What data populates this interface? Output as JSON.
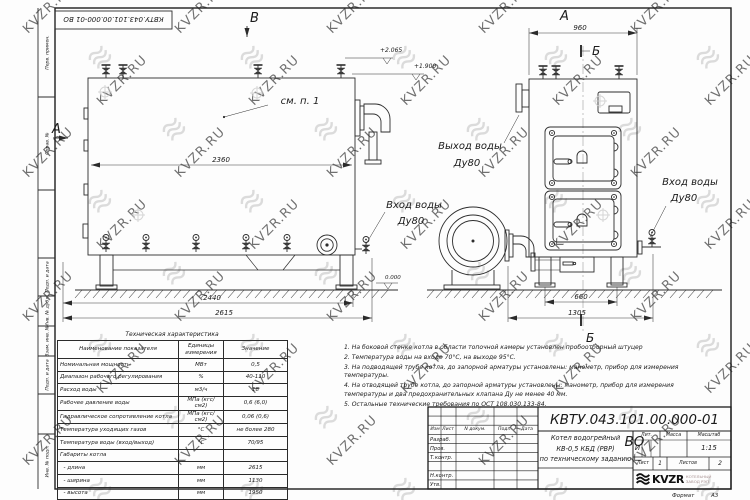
{
  "stamp": {
    "doc_number": "КВТУ.043.101.00.000-01 ВО"
  },
  "frame": {
    "margin_labels": [
      "Перв. примен.",
      "Справ. №",
      "Подп. и дата",
      "Инв. № дубл.",
      "Взам. инв. №",
      "Подп. и дата",
      "Инв. № подл."
    ],
    "format_label": "Формат",
    "format_value": "А3"
  },
  "watermark": {
    "text": "KVZR.RU"
  },
  "left_view": {
    "view_letter_b": "В",
    "section_letter_a": "А",
    "see_note": "см. п. 1",
    "dim_inner": "2360",
    "dim_base": "2440",
    "dim_overall": "2615",
    "elev_top": "+2.065",
    "elev_mid": "+1.900",
    "elev_zero": "0.000",
    "inlet_line1": "Вход воды",
    "inlet_line2": "Ду80"
  },
  "right_view": {
    "view_letter_a": "А",
    "dim_top": "960",
    "section_letter_top": "Б",
    "section_letter_bottom": "Б",
    "outlet_line1": "Выход воды",
    "outlet_line2": "Ду80",
    "inlet_line1": "Вход воды",
    "inlet_line2": "Ду80",
    "dim_legs": "660",
    "dim_base": "1305"
  },
  "spec_table": {
    "title": "Техническая характеристика",
    "headers": [
      "Наименование показателя",
      "Единицы измерения",
      "Значение"
    ],
    "rows": [
      [
        "Номинальная мощность",
        "МВт",
        "0,5"
      ],
      [
        "Диапазон рабочего регулирования",
        "%",
        "40-110"
      ],
      [
        "Расход воды",
        "м3/ч",
        "18"
      ],
      [
        "Рабочее давление воды",
        "МПа (кгс/см2)",
        "0,6 (6,0)"
      ],
      [
        "Гидравлическое сопротивление котла",
        "МПа (кгс/см2)",
        "0,06 (0,6)"
      ],
      [
        "Температура уходящих газов",
        "°С",
        "не более 280"
      ],
      [
        "Температура воды (вход/выход)",
        "°С",
        "70/95"
      ],
      [
        "Габариты котла",
        "",
        ""
      ],
      [
        "  - длина",
        "мм",
        "2615"
      ],
      [
        "  - ширина",
        "мм",
        "1130"
      ],
      [
        "  - высота",
        "мм",
        "1950"
      ]
    ]
  },
  "notes": [
    "1. На боковой стенке котла в области топочной камеры установлен пробоотборный штуцер",
    "2. Температура воды на входе 70°С, на выходе 95°С.",
    "3. На подводящей трубе котла, до запорной арматуры установлены: манометр, прибор для измерения температуры.",
    "4. На отводящей трубе котла, до запорной арматуры установлены: манометр, прибор для измерения температуры и два предохранительных клапана Ду не менее 40 мм.",
    "5. Остальные технические требования по ОСТ 108.030.133-84."
  ],
  "title_block": {
    "doc_number": "КВТУ.043.101.00.000-01 ВО",
    "product_line1": "Котел водогрейный",
    "product_line2": "КВ-0,5 КБД (РВР)",
    "product_line3": "по техническому заданию",
    "sig_col_headers": [
      "Изм",
      "Лист",
      "N докум.",
      "Подп.",
      "Дата"
    ],
    "sig_rows": [
      "Разраб.",
      "Пров.",
      "Т.контр.",
      "",
      "Н.контр.",
      "Утв."
    ],
    "lit_label": "Лит.",
    "lit_value": "И",
    "mass_label": "Масса",
    "scale_label": "Масштаб",
    "scale_value": "1:15",
    "sheet_label": "Лист",
    "sheet_value": "1",
    "sheets_label": "Листов",
    "sheets_value": "2",
    "logo_text": "KVZR",
    "logo_sub1": "КОТЕЛЬНЫЙ",
    "logo_sub2": "ЗАВОД РЭП"
  }
}
